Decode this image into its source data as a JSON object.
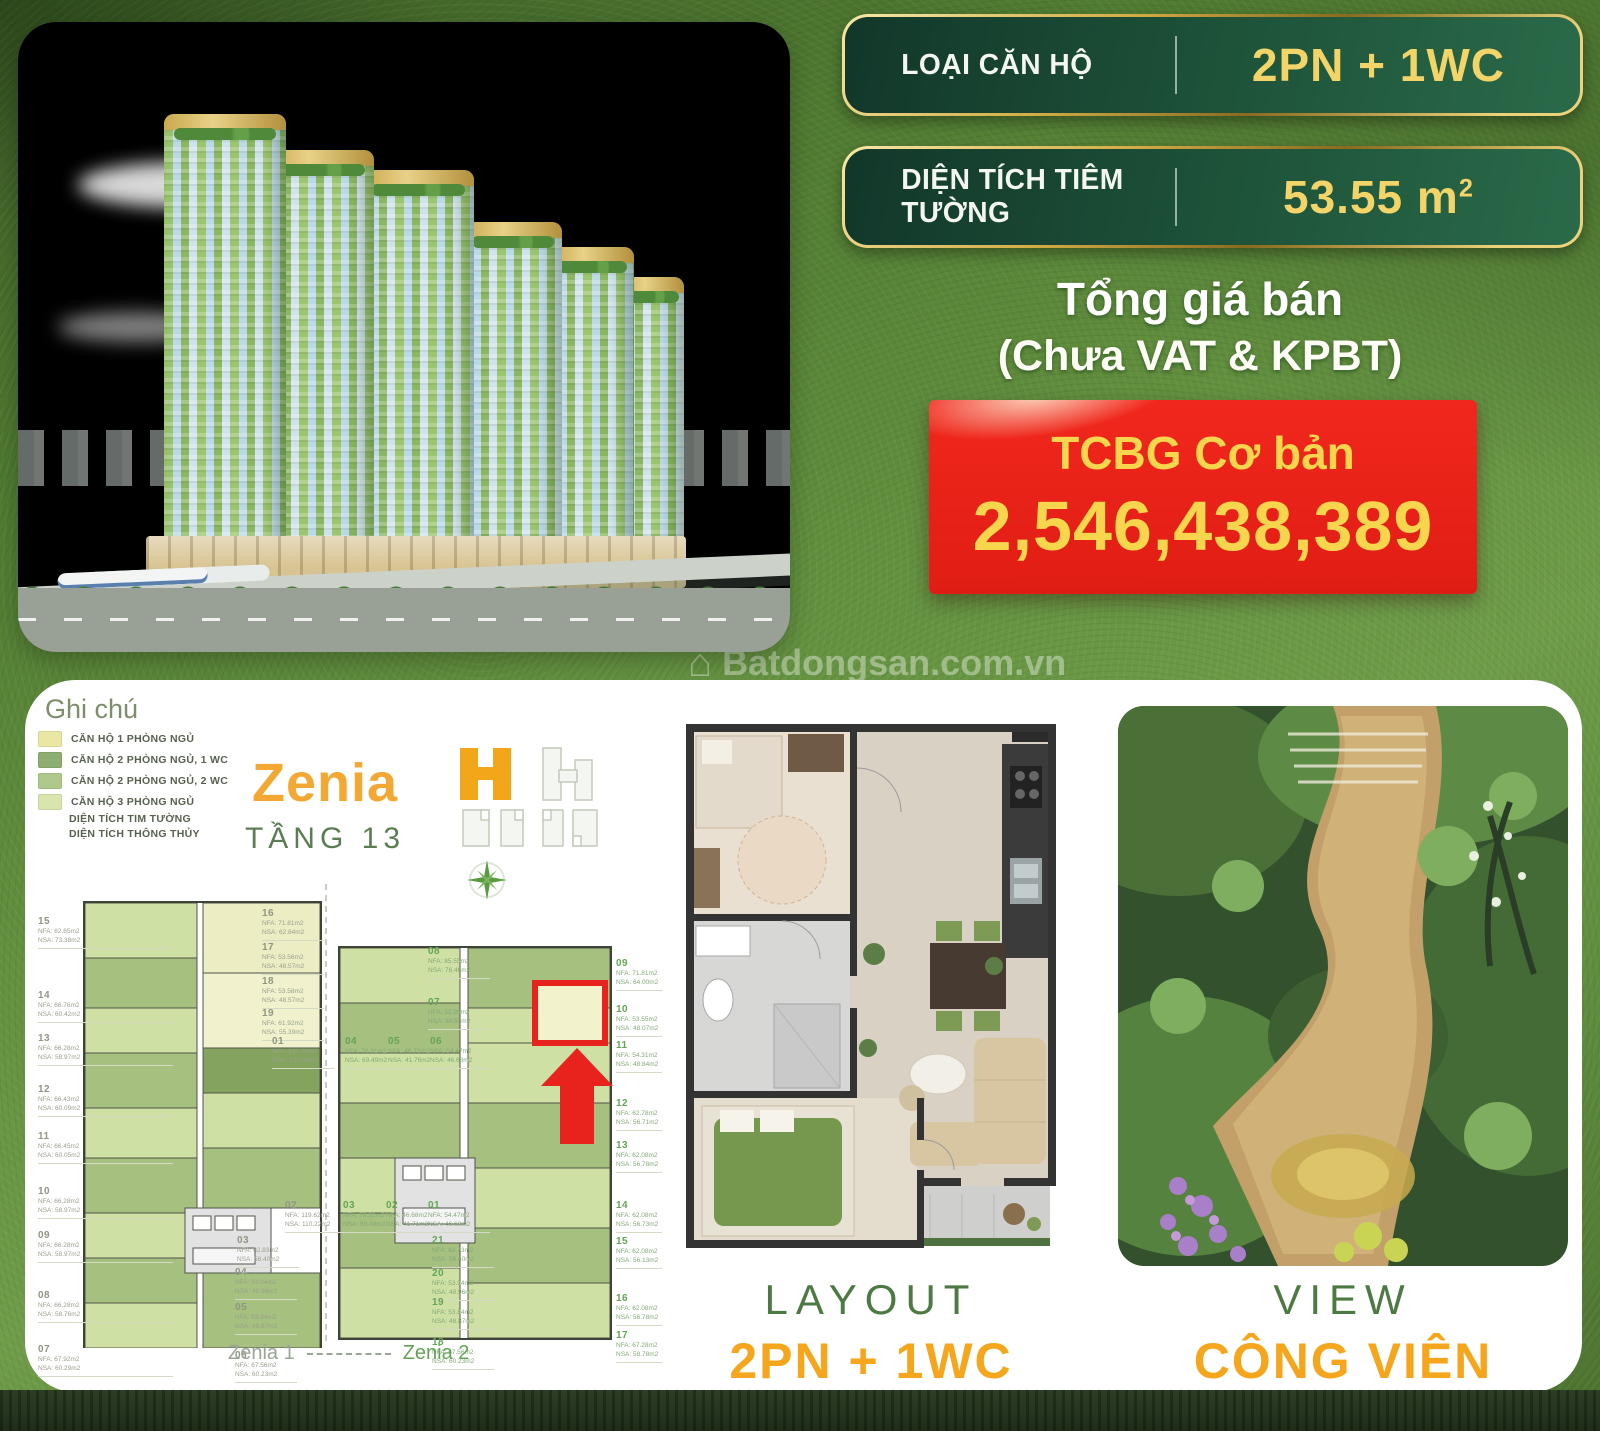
{
  "header": {
    "badge1": {
      "label": "LOẠI CĂN  HỘ",
      "value": "2PN + 1WC"
    },
    "badge2": {
      "label": "DIỆN TÍCH TIÊM TƯỜNG",
      "value": "53.55",
      "unit": "m",
      "sup": "2"
    },
    "price_title": "Tổng giá bán",
    "price_subtitle": "(Chưa VAT & KPBT)",
    "price_box": {
      "label": "TCBG Cơ bản",
      "value": "2,546,438,389"
    }
  },
  "watermark": {
    "text": "Batdongsan.com.vn",
    "icon": "⌂"
  },
  "legend": {
    "title": "Ghi chú",
    "items": [
      {
        "label": "CĂN HỘ 1 PHÒNG NGỦ",
        "color": "#eae6a4"
      },
      {
        "label": "CĂN HỘ 2 PHÒNG NGỦ, 1 WC",
        "color": "#8fae72"
      },
      {
        "label": "CĂN HỘ 2 PHÒNG NGỦ, 2 WC",
        "color": "#aec98b"
      },
      {
        "label": "CĂN HỘ 3 PHÒNG NGỦ",
        "color": "#d8e6ae"
      }
    ],
    "notes": [
      "DIỆN TÍCH TIM TƯỜNG",
      "DIỆN TÍCH THÔNG THỦY"
    ]
  },
  "tower": {
    "name": "Zenia",
    "floor": "TẦNG 13"
  },
  "floorplan": {
    "zenia1_label": "Zenia 1",
    "zenia2_label": "Zenia 2",
    "units": [
      {
        "no": "15",
        "nfa": "82.65m2",
        "nsa": "73.38m2",
        "x": 38,
        "y": 916,
        "g": 0
      },
      {
        "no": "14",
        "nfa": "66.76m2",
        "nsa": "60.42m2",
        "x": 38,
        "y": 990,
        "g": 0
      },
      {
        "no": "13",
        "nfa": "66.28m2",
        "nsa": "58.97m2",
        "x": 38,
        "y": 1033,
        "g": 0
      },
      {
        "no": "12",
        "nfa": "66.43m2",
        "nsa": "60.09m2",
        "x": 38,
        "y": 1084,
        "g": 0
      },
      {
        "no": "11",
        "nfa": "66.45m2",
        "nsa": "60.05m2",
        "x": 38,
        "y": 1131,
        "g": 0
      },
      {
        "no": "10",
        "nfa": "66.28m2",
        "nsa": "58.97m2",
        "x": 38,
        "y": 1186,
        "g": 0
      },
      {
        "no": "09",
        "nfa": "66.28m2",
        "nsa": "58.97m2",
        "x": 38,
        "y": 1230,
        "g": 0
      },
      {
        "no": "08",
        "nfa": "66.28m2",
        "nsa": "58.76m2",
        "x": 38,
        "y": 1290,
        "g": 0
      },
      {
        "no": "07",
        "nfa": "67.92m2",
        "nsa": "60.29m2",
        "x": 38,
        "y": 1344,
        "g": 0
      },
      {
        "no": "16",
        "nfa": "71.81m2",
        "nsa": "62.84m2",
        "x": 262,
        "y": 908,
        "g": 0
      },
      {
        "no": "17",
        "nfa": "53.56m2",
        "nsa": "48.57m2",
        "x": 262,
        "y": 942,
        "g": 0
      },
      {
        "no": "18",
        "nfa": "53.58m2",
        "nsa": "48.57m2",
        "x": 262,
        "y": 976,
        "g": 0
      },
      {
        "no": "19",
        "nfa": "61.92m2",
        "nsa": "55.39m2",
        "x": 262,
        "y": 1008,
        "g": 0
      },
      {
        "no": "01",
        "nfa": "132.76m2",
        "nsa": "120.39m2",
        "x": 272,
        "y": 1036,
        "g": 0
      },
      {
        "no": "02",
        "nfa": "119.62m2",
        "nsa": "110.22m2",
        "x": 285,
        "y": 1200,
        "g": 0
      },
      {
        "no": "03",
        "nfa": "62.83m2",
        "nsa": "56.40m2",
        "x": 237,
        "y": 1235,
        "g": 0
      },
      {
        "no": "04",
        "nfa": "53.94m2",
        "nsa": "48.96m2",
        "x": 235,
        "y": 1267,
        "g": 0
      },
      {
        "no": "05",
        "nfa": "53.84m2",
        "nsa": "48.87m2",
        "x": 235,
        "y": 1302,
        "g": 0
      },
      {
        "no": "06",
        "nfa": "67.56m2",
        "nsa": "60.23m2",
        "x": 235,
        "y": 1350,
        "g": 0
      },
      {
        "no": "08",
        "nfa": "85.55m2",
        "nsa": "76.46m2",
        "x": 428,
        "y": 946,
        "g": 1
      },
      {
        "no": "07",
        "nfa": "52.95m2",
        "nsa": "50.55m2",
        "x": 428,
        "y": 997,
        "g": 1
      },
      {
        "no": "04",
        "nfa": "76.31m2",
        "nsa": "69.49m2",
        "x": 345,
        "y": 1036,
        "g": 1
      },
      {
        "no": "05",
        "nfa": "46.73m2",
        "nsa": "41.76m2",
        "x": 388,
        "y": 1036,
        "g": 1
      },
      {
        "no": "06",
        "nfa": "54.47m2",
        "nsa": "46.68m2",
        "x": 430,
        "y": 1036,
        "g": 1
      },
      {
        "no": "09",
        "nfa": "71.81m2",
        "nsa": "64.00m2",
        "x": 616,
        "y": 958,
        "g": 1
      },
      {
        "no": "10",
        "nfa": "53.55m2",
        "nsa": "48.07m2",
        "x": 616,
        "y": 1004,
        "g": 1
      },
      {
        "no": "11",
        "nfa": "54.31m2",
        "nsa": "48.84m2",
        "x": 616,
        "y": 1040,
        "g": 1
      },
      {
        "no": "12",
        "nfa": "62.78m2",
        "nsa": "56.71m2",
        "x": 616,
        "y": 1098,
        "g": 1
      },
      {
        "no": "13",
        "nfa": "62.08m2",
        "nsa": "56.78m2",
        "x": 616,
        "y": 1140,
        "g": 1
      },
      {
        "no": "14",
        "nfa": "62.08m2",
        "nsa": "56.73m2",
        "x": 616,
        "y": 1200,
        "g": 1
      },
      {
        "no": "15",
        "nfa": "62.08m2",
        "nsa": "56.13m2",
        "x": 616,
        "y": 1236,
        "g": 1
      },
      {
        "no": "16",
        "nfa": "62.08m2",
        "nsa": "56.78m2",
        "x": 616,
        "y": 1293,
        "g": 1
      },
      {
        "no": "17",
        "nfa": "67.28m2",
        "nsa": "58.78m2",
        "x": 616,
        "y": 1330,
        "g": 1
      },
      {
        "no": "03",
        "nfa": "76.31m2",
        "nsa": "69.48m2",
        "x": 343,
        "y": 1200,
        "g": 1
      },
      {
        "no": "02",
        "nfa": "46.68m2",
        "nsa": "41.71m2",
        "x": 386,
        "y": 1200,
        "g": 1
      },
      {
        "no": "01",
        "nfa": "54.47m2",
        "nsa": "46.68m2",
        "x": 428,
        "y": 1200,
        "g": 1
      },
      {
        "no": "21",
        "nfa": "62.73m2",
        "nsa": "56.40m2",
        "x": 432,
        "y": 1235,
        "g": 1
      },
      {
        "no": "20",
        "nfa": "53.94m2",
        "nsa": "48.96m2",
        "x": 432,
        "y": 1268,
        "g": 1
      },
      {
        "no": "19",
        "nfa": "53.84m2",
        "nsa": "48.87m2",
        "x": 432,
        "y": 1297,
        "g": 1
      },
      {
        "no": "18",
        "nfa": "67.56m2",
        "nsa": "60.23m2",
        "x": 432,
        "y": 1337,
        "g": 1
      }
    ]
  },
  "layout_panel": {
    "title": "LAYOUT",
    "subtitle": "2PN + 1WC"
  },
  "view_panel": {
    "title": "VIEW",
    "subtitle": "CÔNG VIÊN"
  },
  "colors": {
    "accent_gold": "#f2d469",
    "accent_orange": "#f5a61d",
    "badge_green": "#1c4f37",
    "price_red": "#e8221c",
    "highlight_red": "#e8221c"
  }
}
